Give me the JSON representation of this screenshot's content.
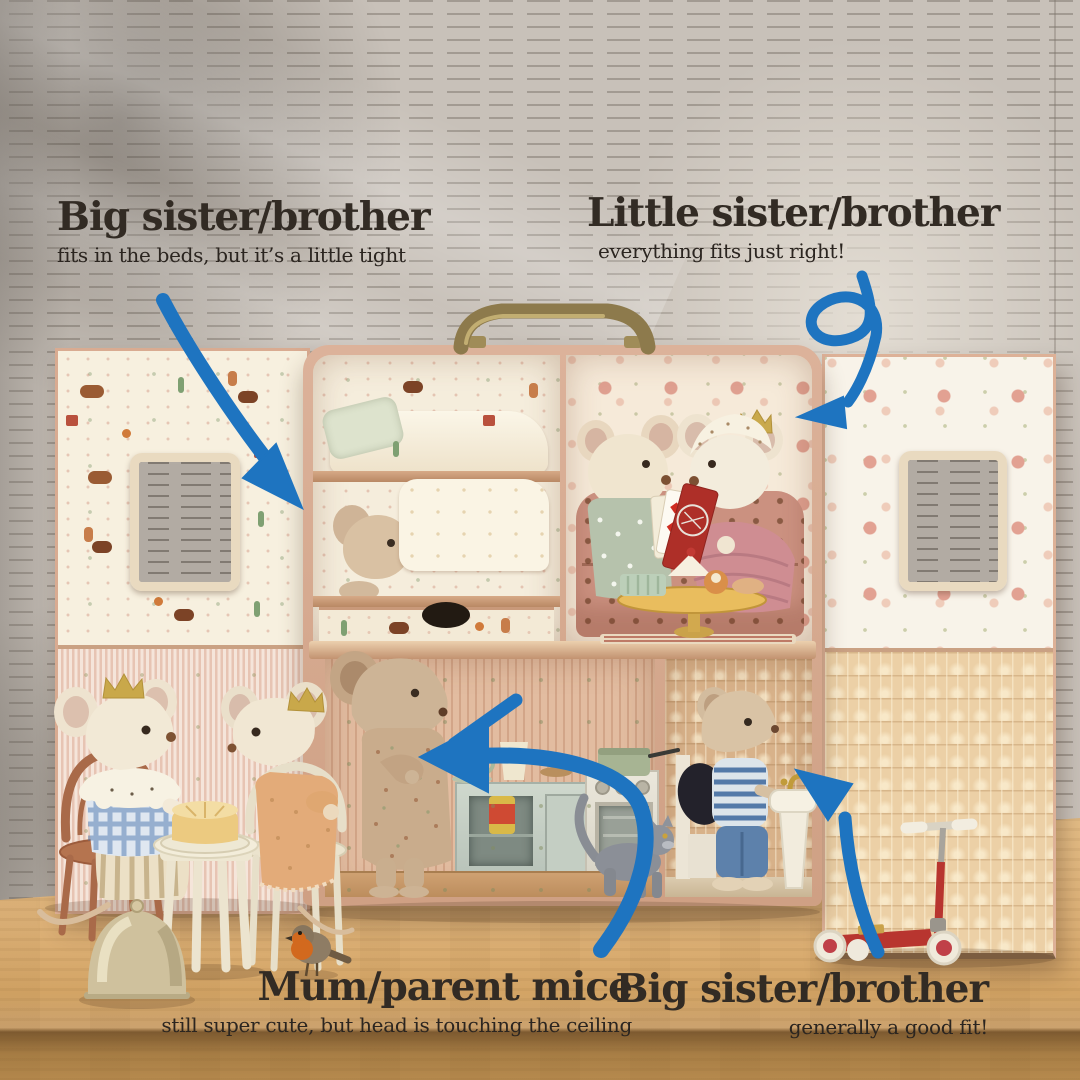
{
  "annotations": {
    "top_left": {
      "title": "Big sister/brother",
      "subtitle": "fits in the beds, but it’s a little tight"
    },
    "top_right": {
      "title": "Little sister/brother",
      "subtitle": "everything fits just right!"
    },
    "bottom_center": {
      "title": "Mum/parent mice",
      "subtitle": "still super cute, but head is touching the ceiling"
    },
    "bottom_right": {
      "title": "Big sister/brother",
      "subtitle": "generally a good fit!"
    }
  },
  "colors": {
    "annotation_text": "#322b24",
    "arrow_blue": "#1e74c0",
    "background_wall": "#c8c1b9",
    "wood_table": "#d7ab72",
    "suitcase_shell": "#d8ab92"
  }
}
